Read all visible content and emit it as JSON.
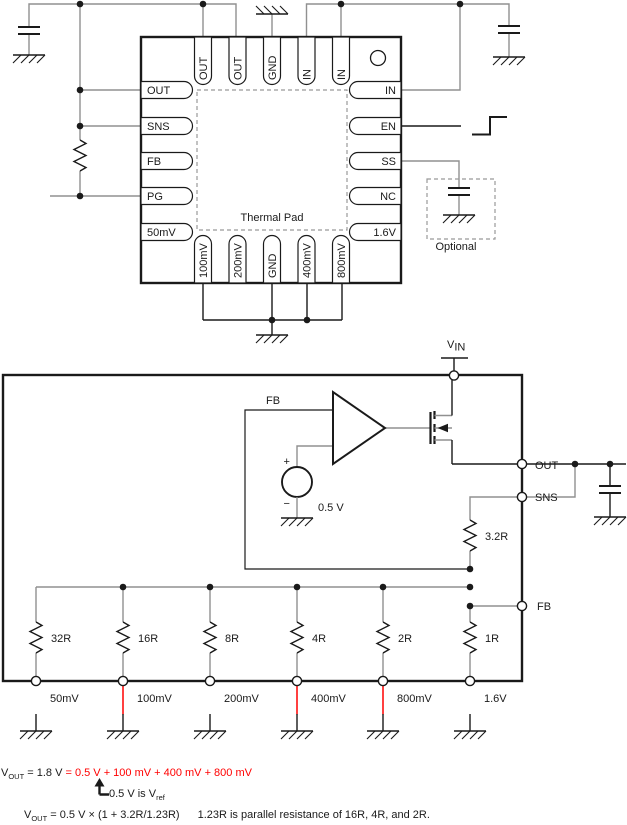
{
  "pkg": {
    "left": [
      "OUT",
      "SNS",
      "FB",
      "PG",
      "50mV"
    ],
    "top": [
      "OUT",
      "OUT",
      "GND",
      "IN",
      "IN"
    ],
    "right": [
      "IN",
      "EN",
      "SS",
      "NC",
      "1.6V"
    ],
    "bottom": [
      "100mV",
      "200mV",
      "GND",
      "400mV",
      "800mV"
    ],
    "thermal_pad": "Thermal Pad",
    "optional": "Optional"
  },
  "sch": {
    "vin": "V",
    "vin_sub": "IN",
    "fb": "FB",
    "plus": "+",
    "minus": "−",
    "vref": "0.5 V",
    "r_top": "3.2R",
    "nodes": {
      "out": "OUT",
      "sns": "SNS",
      "fb": "FB"
    },
    "ladder": [
      {
        "r": "32R",
        "pin": "50mV"
      },
      {
        "r": "16R",
        "pin": "100mV"
      },
      {
        "r": "8R",
        "pin": "200mV"
      },
      {
        "r": "4R",
        "pin": "400mV"
      },
      {
        "r": "2R",
        "pin": "800mV"
      },
      {
        "r": "1R",
        "pin": "1.6V"
      }
    ]
  },
  "formulas": {
    "l1_v": "V",
    "l1_vsub": "OUT",
    "l1_black": " = 1.8 V ",
    "l1_red": "= 0.5 V + 100 mV + 400 mV + 800 mV",
    "l2_text": "0.5 V is V",
    "l2_sub": "ref",
    "l3_v": "V",
    "l3_vsub": "OUT",
    "l3_expr": " = 0.5 V × (1 + 3.2R/1.23R)",
    "l3_note": "1.23R is parallel resistance of 16R, 4R, and 2R."
  },
  "colors": {
    "wire": "#909090",
    "red": "#ff0000",
    "ink": "#1a1a1a"
  }
}
